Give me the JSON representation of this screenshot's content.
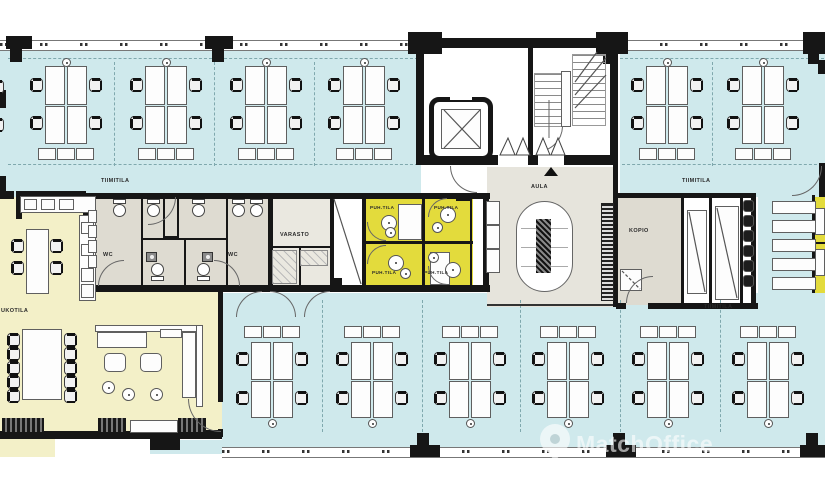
{
  "document": {
    "type": "office-floor-plan"
  },
  "labels": {
    "tiimitila_1": "TIIMITILA",
    "tiimitila_2": "TIIMITILA",
    "tiimitila_3": "TIIMITILA",
    "aula": "AULA",
    "varasto": "VARASTO",
    "kopio": "KOPIO",
    "wc_1": "WC",
    "wc_2": "WC",
    "puh_1": "PUH.TILA",
    "puh_2": "PUH.TILA",
    "puh_3": "PUH.TILA",
    "puh_4": "PUH.TILA",
    "break_room": "UKOTILA"
  },
  "watermark": {
    "text": "MatchOffice",
    "icon": "map-pin-icon"
  },
  "colors": {
    "open_space": "#cfe9ec",
    "break_area": "#f3f0c8",
    "phone_rooms": "#e3db3c",
    "service_rooms": "#dedbd1",
    "storage_room": "#eae8e0",
    "lobby": "#e6e4dc",
    "walls": "#161616",
    "furniture_line": "#5f5f5f",
    "watermark": "rgba(255,255,255,0.6)"
  }
}
